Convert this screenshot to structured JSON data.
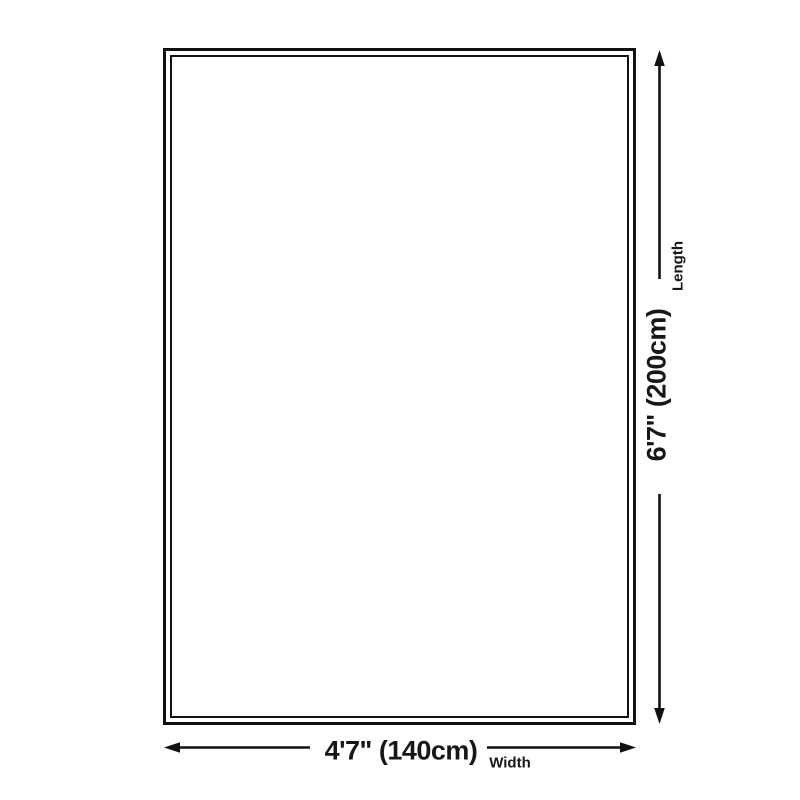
{
  "page": {
    "background_color": "#ffffff",
    "line_color": "#111111",
    "text_color": "#171717"
  },
  "diagram": {
    "kind": "product-dimension-diagram",
    "shape": "rectangle-double-border",
    "length": {
      "value": "6'7\" (200cm)",
      "label": "Length"
    },
    "width": {
      "value": "4'7\" (140cm)",
      "label": "Width"
    }
  }
}
